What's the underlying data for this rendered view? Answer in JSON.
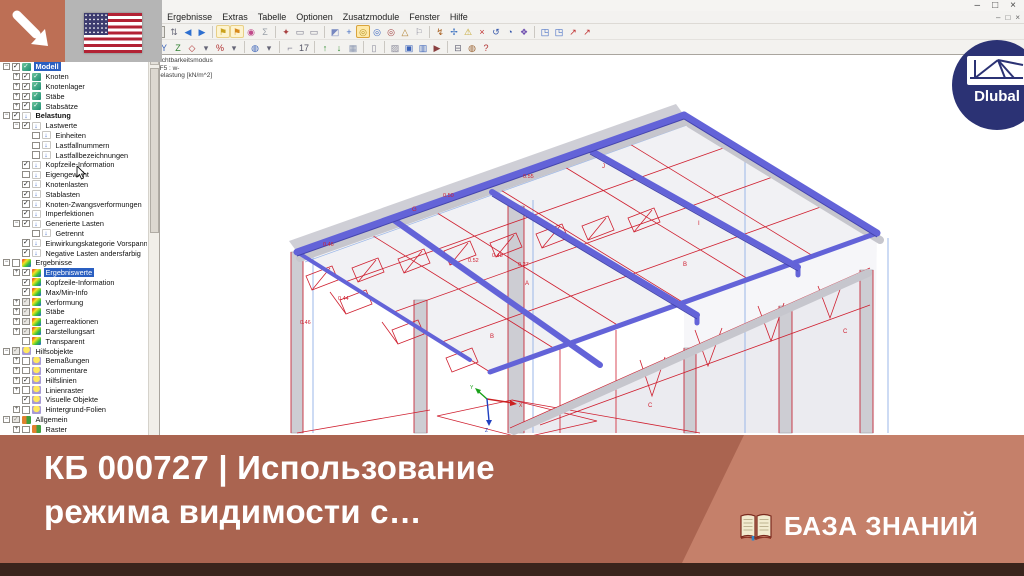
{
  "window": {
    "controls": [
      "–",
      "□",
      "×"
    ],
    "child_controls": [
      "–",
      "□",
      "×"
    ],
    "menu": [
      "Datei",
      "Bearbeiten",
      "Ansicht",
      "Einfügen",
      "Berechnung",
      "Ergebnisse",
      "Extras",
      "Tabelle",
      "Optionen",
      "Zusatzmodule",
      "Fenster",
      "Hilfe"
    ]
  },
  "toolbar1": {
    "loadcase_combo": "LF5 - w-",
    "icons": [
      {
        "n": "new-model-icon",
        "g": "◉",
        "c": "#4a6fae"
      },
      {
        "n": "open-project-icon",
        "g": "▤",
        "c": "#c89a30"
      },
      {
        "n": "save-icon",
        "g": "▥",
        "c": "#caa53c"
      },
      {
        "sep": true
      },
      {
        "n": "table-manager-icon",
        "g": "▦",
        "c": "#8a8a96",
        "press": true
      },
      {
        "n": "table-layout-icon",
        "g": "▦",
        "c": "#aaaab4",
        "press": true
      },
      {
        "sep": true
      },
      {
        "n": "loadcase-number-icon",
        "g": "⇩",
        "c": "#2d5bbf"
      },
      {
        "combo": true
      },
      {
        "n": "loadcase-stepper-icon",
        "g": "⇅",
        "c": "#667"
      },
      {
        "n": "prev-loadcase-icon",
        "g": "◀",
        "c": "#2d6fd0"
      },
      {
        "n": "next-loadcase-icon",
        "g": "▶",
        "c": "#2d6fd0"
      },
      {
        "sep": true
      },
      {
        "n": "show-loads-icon",
        "g": "⚑",
        "c": "#caa21c",
        "hl": true
      },
      {
        "n": "show-results-icon",
        "g": "⚑",
        "c": "#d8891c",
        "hl": true
      },
      {
        "n": "result-values-icon",
        "g": "◉",
        "c": "#c04a8a"
      },
      {
        "n": "sum-icon",
        "g": "Σ",
        "c": "#9aa0a8"
      },
      {
        "sep": true
      },
      {
        "n": "display-properties-icon",
        "g": "✦",
        "c": "#a84040"
      },
      {
        "n": "view-panel-icon",
        "g": "▭",
        "c": "#778"
      },
      {
        "n": "view-panel2-icon",
        "g": "▭",
        "c": "#778"
      },
      {
        "sep": true
      },
      {
        "n": "selection-icon",
        "g": "◩",
        "c": "#7788c0"
      },
      {
        "n": "axes-icon",
        "g": "+",
        "c": "#3a66c0"
      },
      {
        "n": "workplane-icon",
        "g": "◎",
        "c": "#b09020",
        "press": true
      },
      {
        "n": "plane-xy-icon",
        "g": "◎",
        "c": "#3a66c0"
      },
      {
        "n": "plane-yz-icon",
        "g": "◎",
        "c": "#a04040"
      },
      {
        "n": "snap-icon",
        "g": "△",
        "c": "#b08030"
      },
      {
        "n": "guide-icon",
        "g": "⚐",
        "c": "#889"
      },
      {
        "sep": true
      },
      {
        "n": "measure-icon",
        "g": "↯",
        "c": "#a86020"
      },
      {
        "n": "move-icon",
        "g": "✢",
        "c": "#3a70c0"
      },
      {
        "n": "check-icon",
        "g": "⚠",
        "c": "#c0a020"
      },
      {
        "n": "delete-icon",
        "g": "×",
        "c": "#c03030"
      },
      {
        "n": "undo-icon",
        "g": "↺",
        "c": "#3355aa"
      },
      {
        "n": "history-icon",
        "g": "◔",
        "c": "#3355aa"
      },
      {
        "n": "connect-icon",
        "g": "❖",
        "c": "#7050b0"
      },
      {
        "sep": true
      },
      {
        "n": "pin-view-blue-icon",
        "g": "◳",
        "c": "#2d5bbf"
      },
      {
        "n": "pin-view-blue2-icon",
        "g": "◳",
        "c": "#2d5bbf"
      },
      {
        "n": "pin-red-icon",
        "g": "↗",
        "c": "#c03030"
      },
      {
        "n": "pin-red2-icon",
        "g": "↗",
        "c": "#c03030"
      }
    ]
  },
  "toolbar2": {
    "icons": [
      {
        "n": "pan-icon",
        "g": "⇔",
        "c": "#667"
      },
      {
        "n": "select-window-icon",
        "g": "▧",
        "c": "#667"
      },
      {
        "n": "rotate-view-icon",
        "g": "↻",
        "c": "#3a62b8"
      },
      {
        "n": "rotate-dd-icon",
        "g": "▾",
        "c": "#667"
      },
      {
        "sep": true
      },
      {
        "n": "zoom-region-icon",
        "g": "▦",
        "c": "#b04040"
      },
      {
        "n": "zoom-in-icon",
        "g": "⊕",
        "c": "#445"
      },
      {
        "n": "zoom-out-icon",
        "g": "⊖",
        "c": "#445"
      },
      {
        "n": "zoom-page-icon",
        "g": "#",
        "c": "#445"
      },
      {
        "n": "zoom-select-icon",
        "g": "✎",
        "c": "#445"
      },
      {
        "sep": true
      },
      {
        "n": "view-x-icon",
        "g": "X",
        "c": "#b03030"
      },
      {
        "n": "view-y-icon",
        "g": "Y",
        "c": "#3a62b8"
      },
      {
        "n": "view-z-icon",
        "g": "Z",
        "c": "#308030"
      },
      {
        "n": "view-iso-icon",
        "g": "◇",
        "c": "#b03030"
      },
      {
        "n": "view-dd-icon",
        "g": "▾",
        "c": "#667"
      },
      {
        "n": "perspective-icon",
        "g": "%",
        "c": "#b03030"
      },
      {
        "n": "perspective-dd-icon",
        "g": "▾",
        "c": "#667"
      },
      {
        "sep": true
      },
      {
        "n": "visibility-mode-icon",
        "g": "◍",
        "c": "#3a62b8"
      },
      {
        "n": "visibility-dd-icon",
        "g": "▾",
        "c": "#667"
      },
      {
        "sep": true
      },
      {
        "n": "angle-icon",
        "g": "⌐",
        "c": "#889"
      },
      {
        "n": "numbering-icon",
        "g": "17",
        "c": "#556"
      },
      {
        "sep": true
      },
      {
        "n": "insert-up-icon",
        "g": "↑",
        "c": "#2e8b2e"
      },
      {
        "n": "insert-down-icon",
        "g": "↓",
        "c": "#2e8b2e"
      },
      {
        "n": "table-grid-icon",
        "g": "▦",
        "c": "#8a96b0"
      },
      {
        "sep": true
      },
      {
        "n": "notebook-icon",
        "g": "▯",
        "c": "#889"
      },
      {
        "sep": true
      },
      {
        "n": "background-icon",
        "g": "▨",
        "c": "#889"
      },
      {
        "n": "snapshot-icon",
        "g": "▣",
        "c": "#3a62b8"
      },
      {
        "n": "save-view-icon",
        "g": "▥",
        "c": "#3a62b8"
      },
      {
        "n": "movie-icon",
        "g": "▶",
        "c": "#8a4040"
      },
      {
        "sep": true
      },
      {
        "n": "print-icon",
        "g": "⊟",
        "c": "#667"
      },
      {
        "n": "globe-icon",
        "g": "◍",
        "c": "#9a6230"
      },
      {
        "n": "help-icon",
        "g": "?",
        "c": "#b03030"
      }
    ]
  },
  "navigator": {
    "items": [
      {
        "label": "Modell",
        "lvl": 0,
        "icon": "model",
        "chk": "on",
        "exp": "minus",
        "sel": true,
        "bold": true
      },
      {
        "label": "Knoten",
        "lvl": 1,
        "icon": "model",
        "chk": "on",
        "exp": "plus"
      },
      {
        "label": "Knotenlager",
        "lvl": 1,
        "icon": "model",
        "chk": "on",
        "exp": "plus"
      },
      {
        "label": "Stäbe",
        "lvl": 1,
        "icon": "model",
        "chk": "on",
        "exp": "plus"
      },
      {
        "label": "Stabsätze",
        "lvl": 1,
        "icon": "model",
        "chk": "on",
        "exp": "plus"
      },
      {
        "label": "Belastung",
        "lvl": 0,
        "icon": "load",
        "chk": "on",
        "exp": "minus",
        "bold": true
      },
      {
        "label": "Lastwerte",
        "lvl": 1,
        "icon": "load",
        "chk": "on",
        "exp": "minus"
      },
      {
        "label": "Einheiten",
        "lvl": 2,
        "icon": "load",
        "chk": "off"
      },
      {
        "label": "Lastfallnummern",
        "lvl": 2,
        "icon": "load",
        "chk": "off"
      },
      {
        "label": "Lastfallbezeichnungen",
        "lvl": 2,
        "icon": "load",
        "chk": "off"
      },
      {
        "label": "Kopfzeile-Information",
        "lvl": 1,
        "icon": "load",
        "chk": "on"
      },
      {
        "label": "Eigengewicht",
        "lvl": 1,
        "icon": "load",
        "chk": "off"
      },
      {
        "label": "Knotenlasten",
        "lvl": 1,
        "icon": "load",
        "chk": "on"
      },
      {
        "label": "Stablasten",
        "lvl": 1,
        "icon": "load",
        "chk": "on"
      },
      {
        "label": "Knoten-Zwangsverformungen",
        "lvl": 1,
        "icon": "load",
        "chk": "on"
      },
      {
        "label": "Imperfektionen",
        "lvl": 1,
        "icon": "load",
        "chk": "on"
      },
      {
        "label": "Generierte Lasten",
        "lvl": 1,
        "icon": "load",
        "chk": "on",
        "exp": "minus"
      },
      {
        "label": "Getrennt",
        "lvl": 2,
        "icon": "load",
        "chk": "off"
      },
      {
        "label": "Einwirkungskategorie Vorspannung",
        "lvl": 1,
        "icon": "load",
        "chk": "on"
      },
      {
        "label": "Negative Lasten andersfarbig",
        "lvl": 1,
        "icon": "load",
        "chk": "on"
      },
      {
        "label": "Ergebnisse",
        "lvl": 0,
        "icon": "result",
        "chk": "off",
        "exp": "minus"
      },
      {
        "label": "Ergebniswerte",
        "lvl": 1,
        "icon": "result",
        "chk": "on",
        "exp": "plus",
        "sel": true
      },
      {
        "label": "Kopfzeile-Information",
        "lvl": 1,
        "icon": "result",
        "chk": "on"
      },
      {
        "label": "Max/Min-Info",
        "lvl": 1,
        "icon": "result",
        "chk": "on"
      },
      {
        "label": "Verformung",
        "lvl": 1,
        "icon": "result",
        "chk": "gray",
        "exp": "plus"
      },
      {
        "label": "Stäbe",
        "lvl": 1,
        "icon": "result",
        "chk": "gray",
        "exp": "plus"
      },
      {
        "label": "Lagerreaktionen",
        "lvl": 1,
        "icon": "result",
        "chk": "gray",
        "exp": "plus"
      },
      {
        "label": "Darstellungsart",
        "lvl": 1,
        "icon": "result",
        "chk": "gray",
        "exp": "plus"
      },
      {
        "label": "Transparent",
        "lvl": 1,
        "icon": "result",
        "chk": "off"
      },
      {
        "label": "Hilfsobjekte",
        "lvl": 0,
        "icon": "helper",
        "chk": "gray",
        "exp": "minus"
      },
      {
        "label": "Bemaßungen",
        "lvl": 1,
        "icon": "helper",
        "chk": "off",
        "exp": "plus"
      },
      {
        "label": "Kommentare",
        "lvl": 1,
        "icon": "helper",
        "chk": "off",
        "exp": "plus"
      },
      {
        "label": "Hilfslinien",
        "lvl": 1,
        "icon": "helper",
        "chk": "on",
        "exp": "plus"
      },
      {
        "label": "Linienraster",
        "lvl": 1,
        "icon": "helper",
        "chk": "off",
        "exp": "plus"
      },
      {
        "label": "Visuelle Objekte",
        "lvl": 1,
        "icon": "helper",
        "chk": "on"
      },
      {
        "label": "Hintergrund-Folien",
        "lvl": 1,
        "icon": "helper",
        "chk": "off",
        "exp": "plus"
      },
      {
        "label": "Allgemein",
        "lvl": 0,
        "icon": "general",
        "chk": "gray",
        "exp": "minus"
      },
      {
        "label": "Raster",
        "lvl": 1,
        "icon": "general",
        "chk": "off",
        "exp": "plus"
      }
    ]
  },
  "viewport": {
    "info_line1": "Sichtbarkeitsmodus",
    "info_line2": "LF5 : w-",
    "info_line3": "Belastung [kN/m^2]",
    "zones": [
      {
        "t": "G"
      },
      {
        "t": "J"
      },
      {
        "t": "I"
      },
      {
        "t": "B"
      },
      {
        "t": "A"
      },
      {
        "t": "B"
      },
      {
        "t": "C"
      },
      {
        "t": "C"
      }
    ],
    "values": [
      {
        "t": "0.50"
      },
      {
        "t": "0.55"
      },
      {
        "t": "0.46"
      },
      {
        "t": "0.48"
      },
      {
        "t": "0.52"
      },
      {
        "t": "0.27"
      },
      {
        "t": "0.44"
      },
      {
        "t": "0.46"
      }
    ],
    "axes": {
      "x": "X",
      "y": "Y",
      "z": "Z"
    },
    "colors": {
      "beam": "#6363d8",
      "wire": "#cf1f2f",
      "member": "#cdcdd3",
      "guide": "#9bb7e8"
    }
  },
  "banner": {
    "title_line1": "КБ 000727 | Использование",
    "title_line2": "режима видимости с…",
    "badge_label": "БАЗА ЗНАНИЙ",
    "bg_left": "#aa6450",
    "bg_right": "#c5806a",
    "footer": "#3a241c"
  },
  "logo": {
    "text": "Dlubal",
    "bg": "#2b3274"
  }
}
